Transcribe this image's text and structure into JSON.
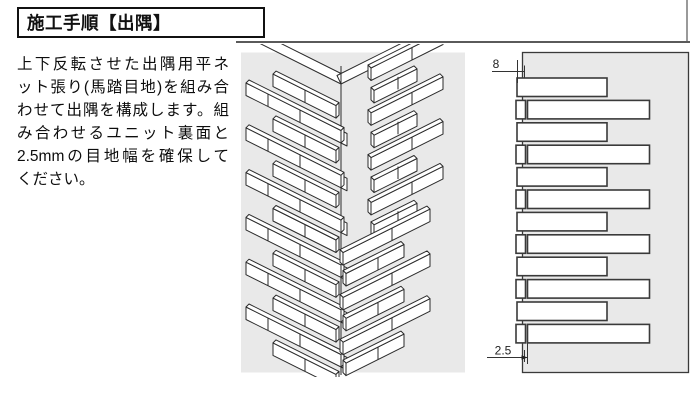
{
  "title_box": {
    "label": "施工手順【出隅】"
  },
  "intro": {
    "lines": [
      "上下反転させた出隅用平ネ",
      "ット張り(馬踏目地)を組み合",
      "わせて出隅を構成します。組",
      "み合わせるユニット裏面と",
      "2.5mmの目地幅を確保して",
      "ください。"
    ]
  },
  "detail_diagram": {
    "dim_protrusion_label": "8",
    "dim_joint_label": "2.5"
  },
  "colors": {
    "panel_background": "#e9e9e9",
    "line_art": "#2b2b2b",
    "tile_fill": "#ffffff",
    "title_border": "#111111",
    "divider": "#5a5a5a"
  }
}
